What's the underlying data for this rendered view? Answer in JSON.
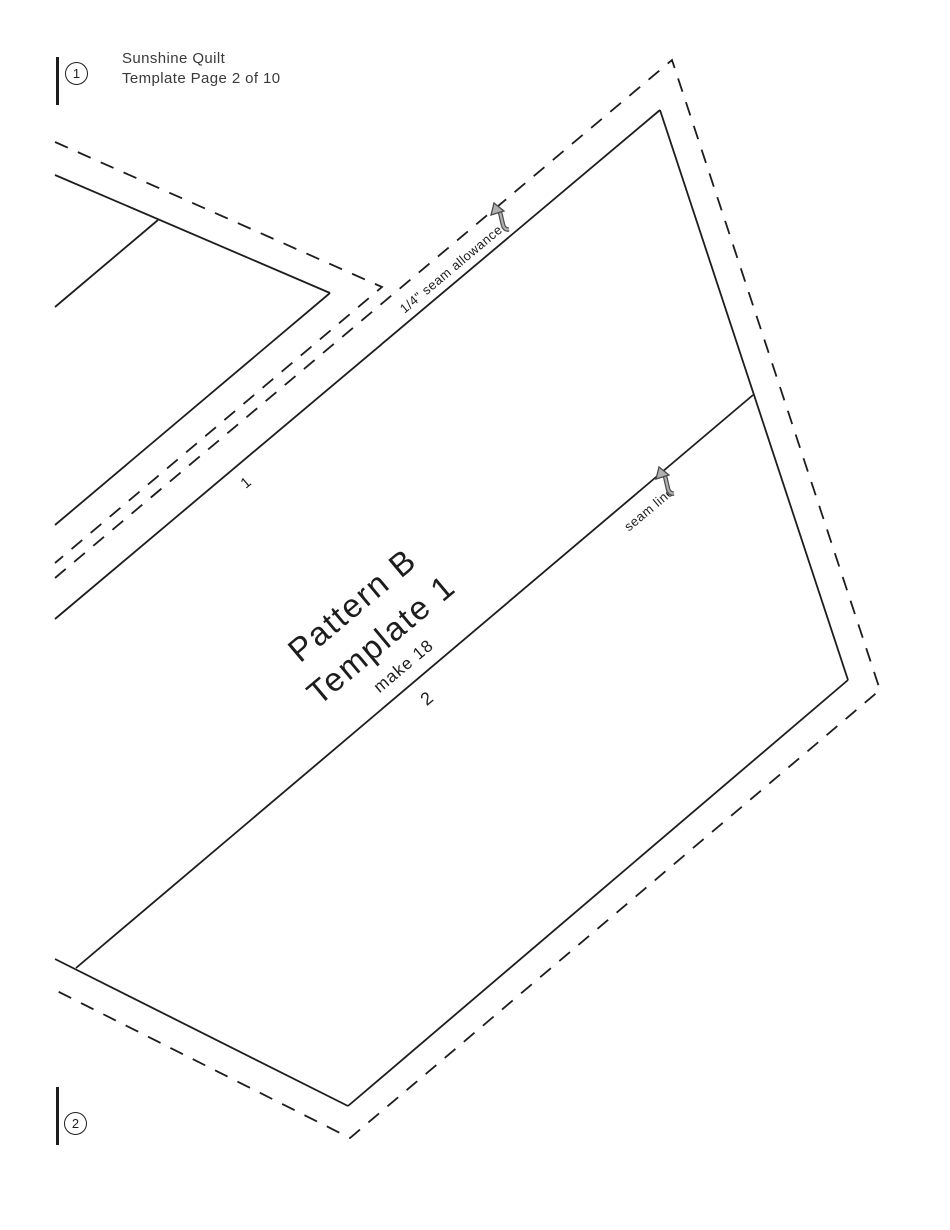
{
  "header": {
    "line1": "Sunshine Quilt",
    "line2": "Template Page 2 of 10"
  },
  "match_marks": {
    "top_number": "1",
    "bottom_number": "2"
  },
  "piece": {
    "name_line1": "Pattern B",
    "name_line2": "Template 1",
    "make_count": "make 18"
  },
  "annotations": {
    "seam_allowance_label": "1/4\" seam allowance",
    "seam_line_label": "seam line",
    "line1_number": "1",
    "line2_number": "2"
  },
  "colors": {
    "line": "#1d1d1d",
    "text": "#3a3a3a",
    "arrow_fill": "#b0b0b0",
    "arrow_stroke": "#4a4a4a"
  }
}
